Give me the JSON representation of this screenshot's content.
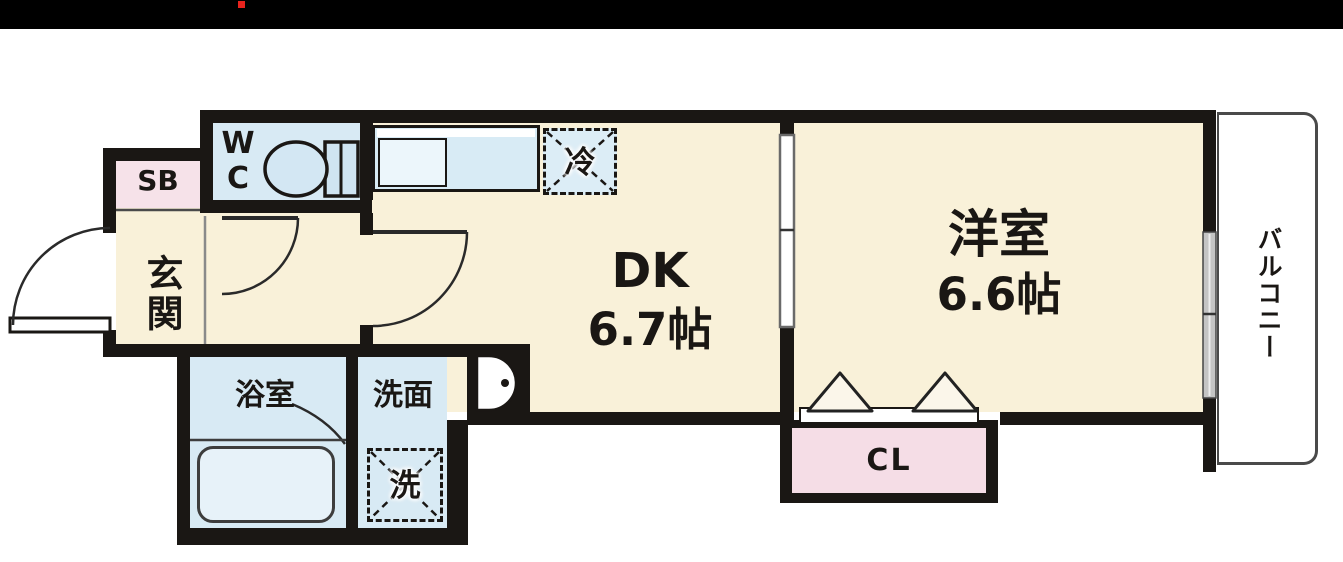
{
  "top_bar": {
    "background": "#000000",
    "red_dot_color": "#e8231d"
  },
  "floor_plan": {
    "colors": {
      "wall": "#1a1714",
      "room_floor": "#f9f1d9",
      "wet_area_blue": "#d8eaf4",
      "shoe_box_pink": "#f6e2e9",
      "closet_pink": "#f5dde6",
      "balcony_white": "#ffffff",
      "tub_blue": "#e7f2f9"
    },
    "rooms": {
      "entrance": {
        "label": "玄関"
      },
      "shoe_box": {
        "label": "SB"
      },
      "toilet": {
        "line1": "W",
        "line2": "C"
      },
      "dining_kitchen": {
        "name": "DK",
        "size": "6.7帖"
      },
      "western_room": {
        "name": "洋室",
        "size": "6.6帖"
      },
      "balcony": {
        "label": "バルコニー"
      },
      "bathroom": {
        "label": "浴室"
      },
      "washroom": {
        "label": "洗面"
      },
      "closet": {
        "label": "CL"
      }
    },
    "fixtures": {
      "washer": {
        "label": "洗"
      },
      "refrigerator": {
        "label": "冷"
      }
    }
  }
}
